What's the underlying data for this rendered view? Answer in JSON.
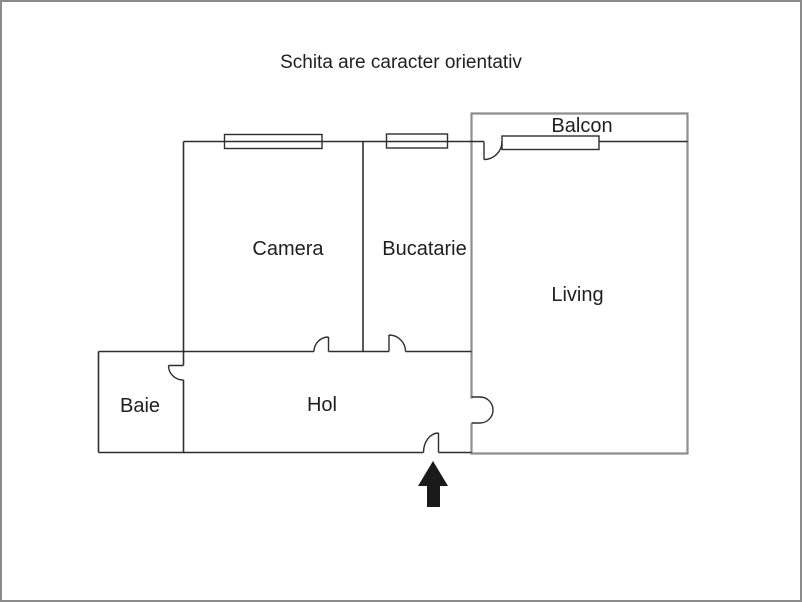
{
  "title": "Schita are caracter orientativ",
  "rooms": {
    "camera": {
      "label": "Camera"
    },
    "bucatarie": {
      "label": "Bucatarie"
    },
    "living": {
      "label": "Living"
    },
    "balcon": {
      "label": "Balcon"
    },
    "baie": {
      "label": "Baie"
    },
    "hol": {
      "label": "Hol"
    }
  },
  "icons": {
    "entrance_arrow": "arrow-up"
  },
  "colors": {
    "background": "#ffffff",
    "frame": "#8a8a8a",
    "wall": "#2e2e2e",
    "outer_rect": "#8e8e8e",
    "text": "#1f1f1f",
    "arrow": "#1a1a1a"
  }
}
